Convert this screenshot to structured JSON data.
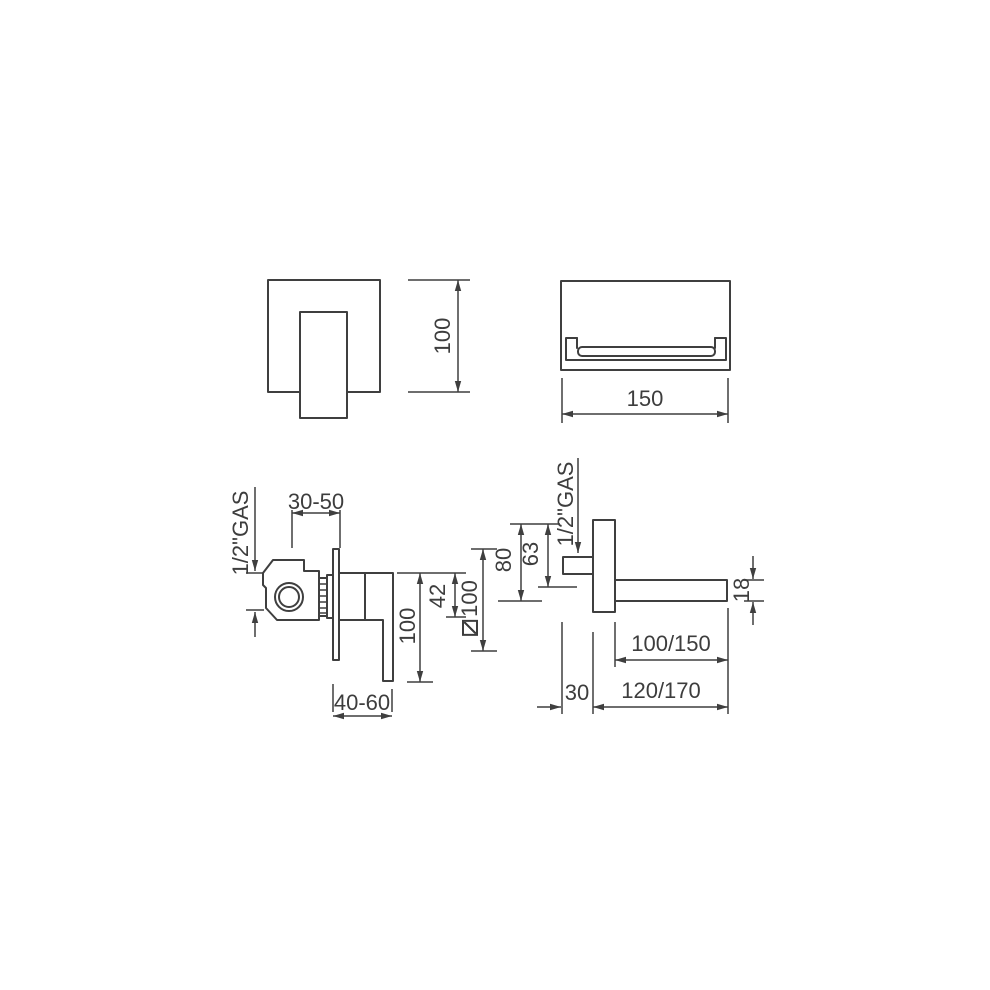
{
  "colors": {
    "line": "#3f3f3f",
    "text": "#3d3d3d",
    "background": "#ffffff"
  },
  "views": {
    "mixer_front_view": {
      "dims": {
        "plate_height": "100"
      }
    },
    "spout_front_view": {
      "dims": {
        "spout_width": "150"
      }
    },
    "mixer_side_view": {
      "dims": {
        "rough_in_depth": "30-50",
        "inlet_thread": "1/2\"GAS",
        "handle_length": "100",
        "cartridge_height": "42",
        "plate_size": "100",
        "plate_size_symbol": "square-section-icon",
        "handle_clearance": "40-60"
      }
    },
    "spout_side_view": {
      "dims": {
        "inlet_thread": "1/2\"GAS",
        "plate_height": "80",
        "inlet_offset": "63",
        "spout_thickness": "18",
        "spout_projection": "100/150",
        "inlet_depth": "30",
        "total_projection": "120/170"
      }
    }
  }
}
